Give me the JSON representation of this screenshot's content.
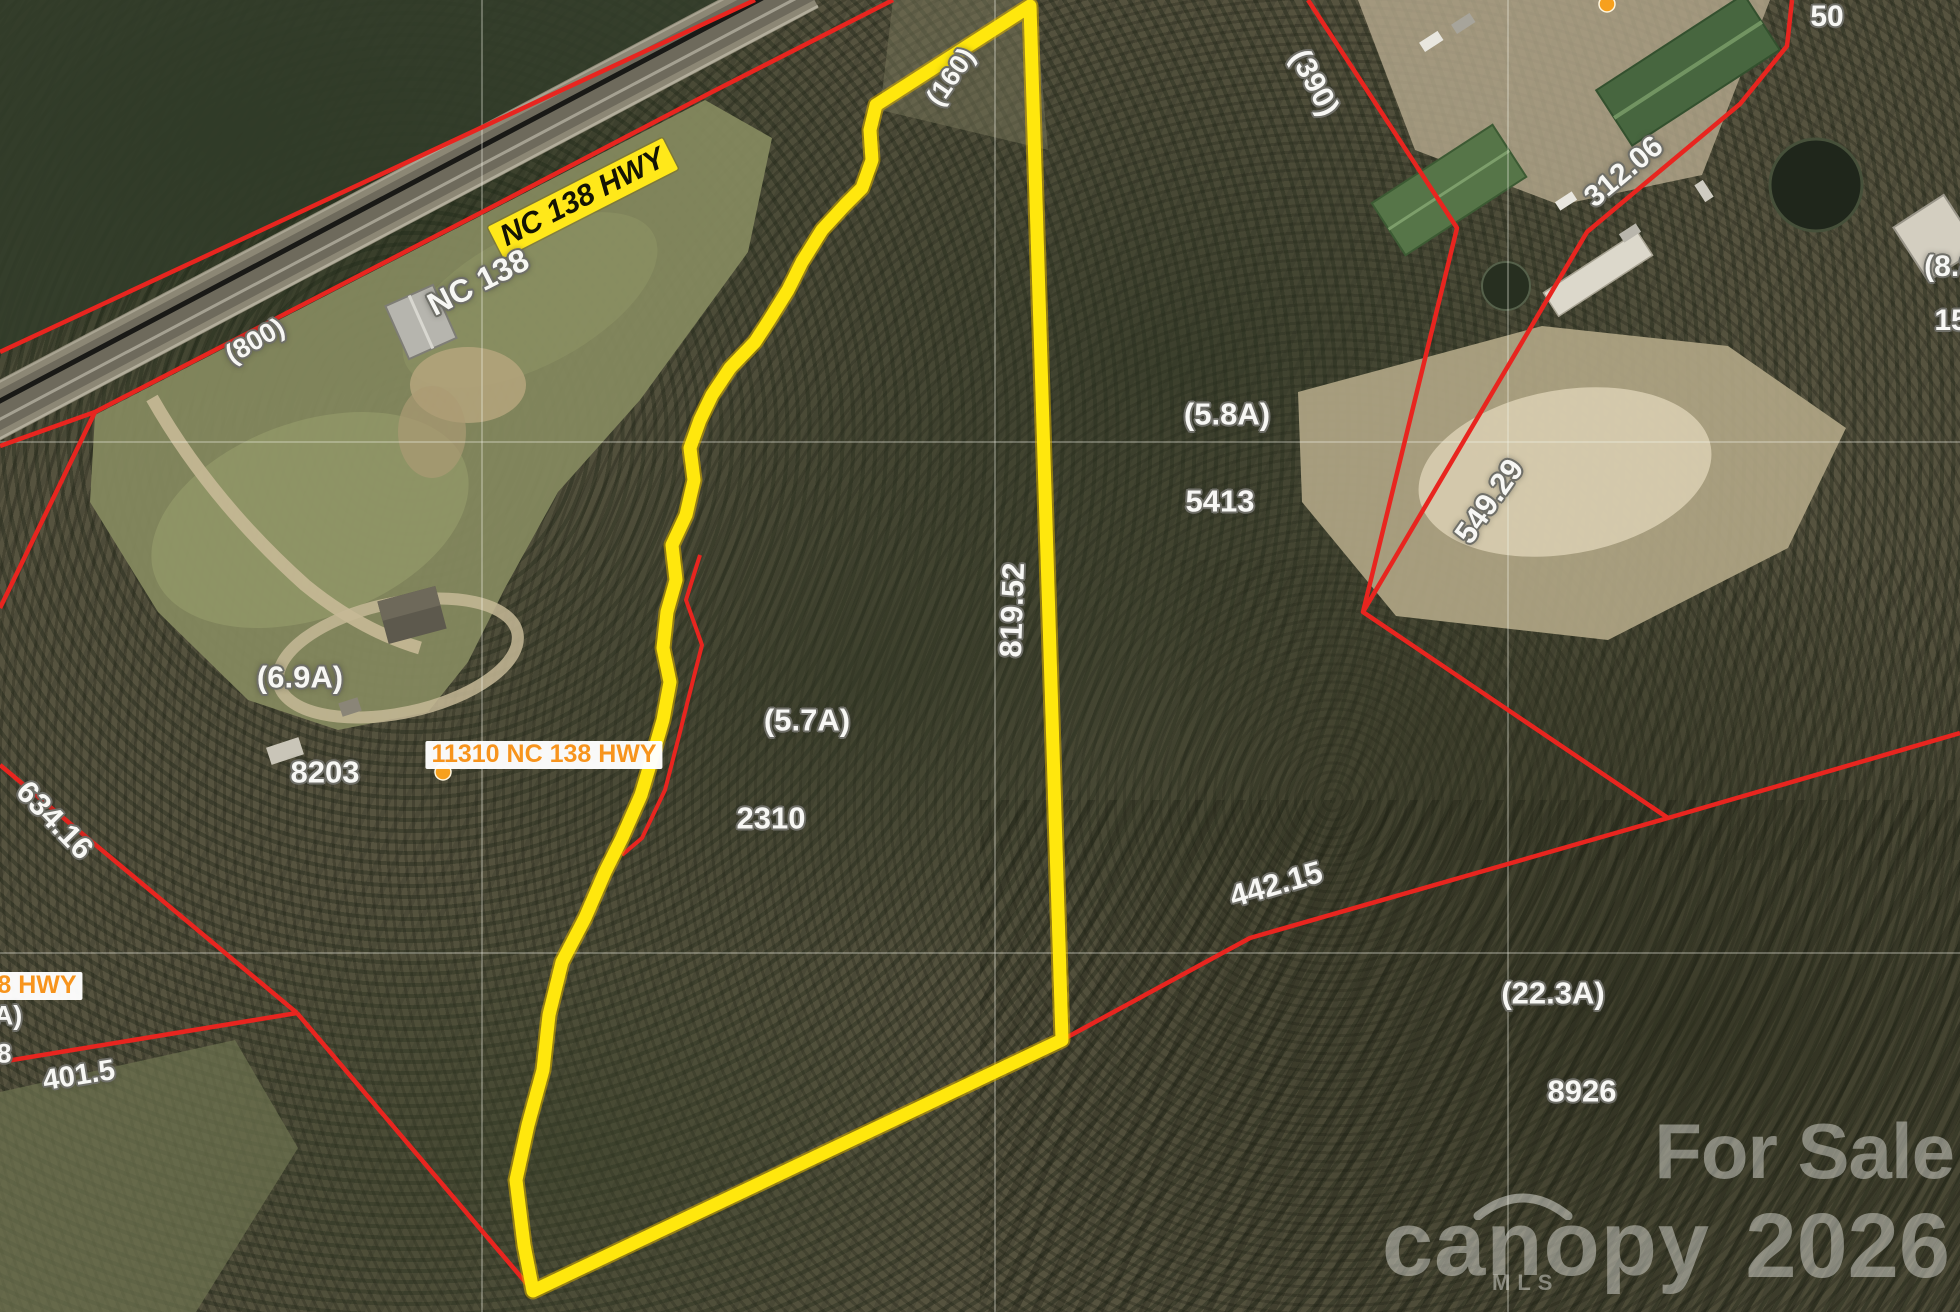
{
  "image_type": "aerial parcel map photo with GIS overlay (MLS listing)",
  "colors": {
    "parcel_line": "#e8251f",
    "subject_parcel_outline": "#ffe70d",
    "label_text": "#f7f7f4",
    "label_halo": "#6f6f68",
    "road_label_bg": "#ffe81a",
    "address_text": "#f7941d",
    "marker_dot": "#f7a01d",
    "watermark": "rgba(248,248,243,0.42)"
  },
  "labels": [
    {
      "id": "road-name-highlight",
      "text": "NC 138 HWY",
      "role": "road-name"
    },
    {
      "id": "road-name",
      "text": "NC 138",
      "role": "road-name"
    },
    {
      "id": "dim-160",
      "text": "(160)",
      "role": "frontage-dimension"
    },
    {
      "id": "dim-800",
      "text": "(800)",
      "role": "frontage-dimension"
    },
    {
      "id": "dim-390",
      "text": "(390)",
      "role": "frontage-dimension"
    },
    {
      "id": "dim-312",
      "text": "312.06",
      "role": "boundary-dimension"
    },
    {
      "id": "dim-50",
      "text": "50",
      "role": "boundary-dimension"
    },
    {
      "id": "acre-8-8-partial",
      "text": "(8.8",
      "role": "acreage-partial"
    },
    {
      "id": "parcel-15-partial",
      "text": "15",
      "role": "parcel-number-partial"
    },
    {
      "id": "acre-5-8",
      "text": "(5.8A)",
      "role": "acreage"
    },
    {
      "id": "parcel-5413",
      "text": "5413",
      "role": "parcel-number"
    },
    {
      "id": "dim-819",
      "text": "819.52",
      "role": "boundary-dimension"
    },
    {
      "id": "acre-6-9",
      "text": "(6.9A)",
      "role": "acreage"
    },
    {
      "id": "parcel-8203",
      "text": "8203",
      "role": "parcel-number"
    },
    {
      "id": "addr-11310",
      "text": "11310 NC 138 HWY",
      "role": "address"
    },
    {
      "id": "acre-5-7",
      "text": "(5.7A)",
      "role": "acreage"
    },
    {
      "id": "parcel-2310",
      "text": "2310",
      "role": "parcel-number"
    },
    {
      "id": "dim-442",
      "text": "442.15",
      "role": "boundary-dimension"
    },
    {
      "id": "acre-22-3",
      "text": "(22.3A)",
      "role": "acreage"
    },
    {
      "id": "parcel-8926",
      "text": "8926",
      "role": "parcel-number"
    },
    {
      "id": "dim-634",
      "text": "634.16",
      "role": "boundary-dimension"
    },
    {
      "id": "addr-38hwy-partial",
      "text": "38 HWY",
      "role": "address-partial"
    },
    {
      "id": "acre-partial-a",
      "text": "A)",
      "role": "acreage-partial"
    },
    {
      "id": "parcel-partial-8",
      "text": "8",
      "role": "parcel-number-partial"
    },
    {
      "id": "dim-401",
      "text": "401.5",
      "role": "boundary-dimension"
    },
    {
      "id": "dim-549",
      "text": "549.29",
      "role": "boundary-dimension"
    }
  ],
  "watermark": {
    "for_sale": "For Sale",
    "brand": "canopy",
    "brand_sub": "MLS",
    "year": "2026"
  }
}
